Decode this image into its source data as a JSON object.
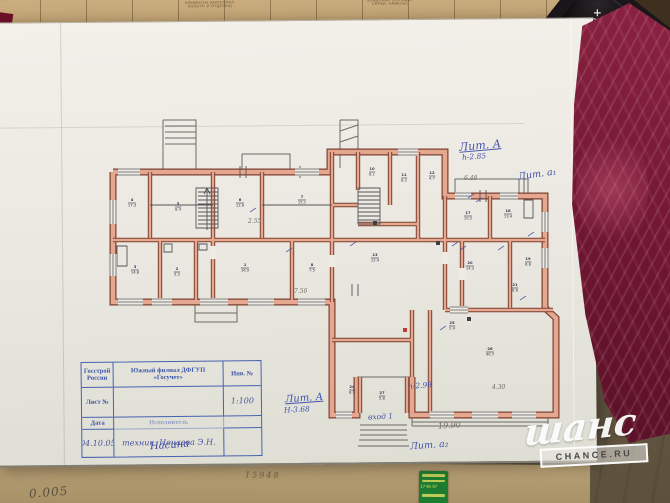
{
  "stamp_header": {
    "title": "П Л А Н",
    "l2a": "строения лит.",
    "l2_hand": "А",
    "l2b": "расположенного в домовл",
    "l3a": "владении по",
    "l3_street": "ул. Осипенко",
    "l3b": "под №",
    "l3_num": "16/14",
    "l4a": "район №",
    "l4b": "уч. №",
    "l5": "Масштаб 1:100 НВ."
  },
  "stamp_table": {
    "org1": "Госстрой",
    "org2": "России",
    "branch1": "Южный филиал ДФГУП",
    "branch2": "«Госучет»",
    "inv": "Инв. №",
    "sheet": "Лист №",
    "scale": "1:100",
    "date_label": "Дата",
    "executor_label": "Исполнитель",
    "date_value": "04.10.05",
    "exec_role": "техник",
    "exec_name": "Нечаева Э.Н.",
    "signature": "Насина"
  },
  "top_strip": {
    "f1a": "ЭЛЕМЕНТЫ (МАТЕРИАЛ,",
    "f1b": "КОНСТР. И ОТДЕЛКА)",
    "f2a": "КЛАДОВЫЕ (СКЛАДЫ,",
    "f2b": "САРАИ, НАВЕСЫ)"
  },
  "bottom_strip": {
    "pencil_note": "0.005",
    "faint_digits": "15948",
    "sticker_phone": "17-61-57"
  },
  "keyboard": {
    "keys": [
      "+/−",
      "00→0"
    ]
  },
  "watermark": {
    "script": "шанс",
    "box": "CHANCE.RU"
  },
  "plan": {
    "colors": {
      "wall": "#e5a78f",
      "wall_outline": "#7c4030",
      "ink": "#4353ac"
    },
    "rooms": [
      {
        "x": 132,
        "y": 203,
        "n": "4",
        "a": "17.3"
      },
      {
        "x": 178,
        "y": 207,
        "n": "5",
        "a": "8.4"
      },
      {
        "x": 240,
        "y": 203,
        "n": "6",
        "a": "12.6"
      },
      {
        "x": 302,
        "y": 200,
        "n": "7",
        "a": "15.1"
      },
      {
        "x": 135,
        "y": 270,
        "n": "3",
        "a": "14.8"
      },
      {
        "x": 177,
        "y": 272,
        "n": "2",
        "a": "5.2"
      },
      {
        "x": 245,
        "y": 268,
        "n": "1",
        "a": "16.9"
      },
      {
        "x": 312,
        "y": 268,
        "n": "8",
        "a": "7.5"
      },
      {
        "x": 372,
        "y": 172,
        "n": "10",
        "a": "6.1"
      },
      {
        "x": 404,
        "y": 178,
        "n": "11",
        "a": "8.2"
      },
      {
        "x": 432,
        "y": 176,
        "n": "12",
        "a": "4.7"
      },
      {
        "x": 375,
        "y": 258,
        "n": "13",
        "a": "12.4"
      },
      {
        "x": 468,
        "y": 216,
        "n": "17",
        "a": "10.2"
      },
      {
        "x": 508,
        "y": 214,
        "n": "18",
        "a": "13.4"
      },
      {
        "x": 528,
        "y": 262,
        "n": "19",
        "a": "6.8"
      },
      {
        "x": 470,
        "y": 266,
        "n": "20",
        "a": "14.3"
      },
      {
        "x": 515,
        "y": 288,
        "n": "21",
        "a": "9.6"
      },
      {
        "x": 452,
        "y": 326,
        "n": "25",
        "a": "2.4"
      },
      {
        "x": 490,
        "y": 352,
        "n": "26",
        "a": "40.7"
      },
      {
        "x": 352,
        "y": 390,
        "n": "24",
        "a": "8.9"
      },
      {
        "x": 382,
        "y": 396,
        "n": "27",
        "a": "5.8"
      }
    ],
    "annotations": [
      {
        "name": "lit-a-main-label",
        "x": 459,
        "y": 139,
        "text": "Лит. А",
        "size": 11,
        "rot": -5,
        "u": 1
      },
      {
        "name": "lit-a-height",
        "x": 462,
        "y": 152,
        "text": "h-2.85",
        "size": 7.5,
        "rot": -4
      },
      {
        "name": "lit-a1-label",
        "x": 518,
        "y": 169,
        "text": "Лит. а₁",
        "size": 9.5,
        "rot": -8
      },
      {
        "name": "lit-a-bottom-label",
        "x": 285,
        "y": 393,
        "text": "Лит. А",
        "size": 10,
        "rot": -4,
        "u": 1
      },
      {
        "name": "lit-a-bottom-height",
        "x": 284,
        "y": 405,
        "text": "Н-3.68",
        "size": 7.5,
        "rot": -3
      },
      {
        "name": "entrance-label",
        "x": 368,
        "y": 412,
        "text": "вход 1",
        "size": 7.5,
        "rot": -3
      },
      {
        "name": "hall-height-label",
        "x": 408,
        "y": 381,
        "text": "h-2.98",
        "size": 7.5,
        "rot": -5
      },
      {
        "name": "dimension-19-90",
        "x": 438,
        "y": 421,
        "text": "19.90",
        "size": 8,
        "rot": -3,
        "cls": "pencil"
      },
      {
        "name": "lit-a2-label",
        "x": 410,
        "y": 440,
        "text": "Лит. а₂",
        "size": 9.5,
        "rot": -4
      },
      {
        "name": "dim-7-56",
        "x": 294,
        "y": 288,
        "text": "7.56",
        "size": 6,
        "cls": "pencil"
      },
      {
        "name": "dim-4-30",
        "x": 492,
        "y": 384,
        "text": "4.30",
        "size": 6,
        "cls": "pencil"
      },
      {
        "name": "dim-6-48",
        "x": 464,
        "y": 175,
        "text": "6.48",
        "size": 6,
        "cls": "pencil"
      },
      {
        "name": "dim-2-55",
        "x": 248,
        "y": 218,
        "text": "2.55",
        "size": 6,
        "cls": "pencil"
      }
    ]
  }
}
